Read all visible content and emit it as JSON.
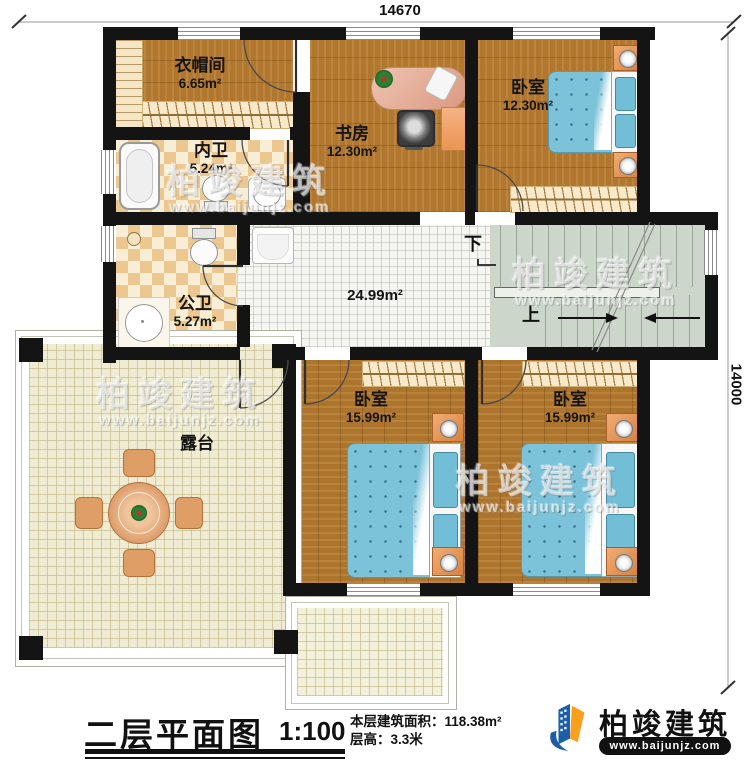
{
  "dimensions": {
    "top": "14670",
    "right": "14000"
  },
  "rooms": {
    "cloakroom": {
      "name": "衣帽间",
      "area": "6.65m²"
    },
    "inner_bath": {
      "name": "内卫",
      "area": "5.24m²"
    },
    "study": {
      "name": "书房",
      "area": "12.30m²"
    },
    "bedroom_tr": {
      "name": "卧室",
      "area": "12.30m²"
    },
    "public_bath": {
      "name": "公卫",
      "area": "5.27m²"
    },
    "hall": {
      "area": "24.99m²"
    },
    "bedroom_bm": {
      "name": "卧室",
      "area": "15.99m²"
    },
    "bedroom_br": {
      "name": "卧室",
      "area": "15.99m²"
    },
    "terrace": {
      "name": "露台"
    }
  },
  "stairs": {
    "down": "下",
    "up": "上"
  },
  "title_block": {
    "title": "二层平面图",
    "scale": "1:100",
    "area_line": "本层建筑面积：118.38m²",
    "height_line": "层高：3.3米"
  },
  "brand": {
    "name": "柏竣建筑",
    "url": "www.baijunjz.com"
  },
  "watermark": {
    "name": "柏竣建筑",
    "url": "www.baijunjz.com"
  },
  "palette": {
    "wall": "#141414",
    "wood": "#b1772f",
    "tile": "#f6f6f3",
    "checker_tan": "#ecc78f",
    "stair": "#cdd6cb",
    "terrace": "#efecd3",
    "bed_blue": "#7cc3da",
    "furniture_orange": "#e0945c",
    "brand_blue": "#1b5ea9",
    "brand_orange": "#f6a01d"
  }
}
